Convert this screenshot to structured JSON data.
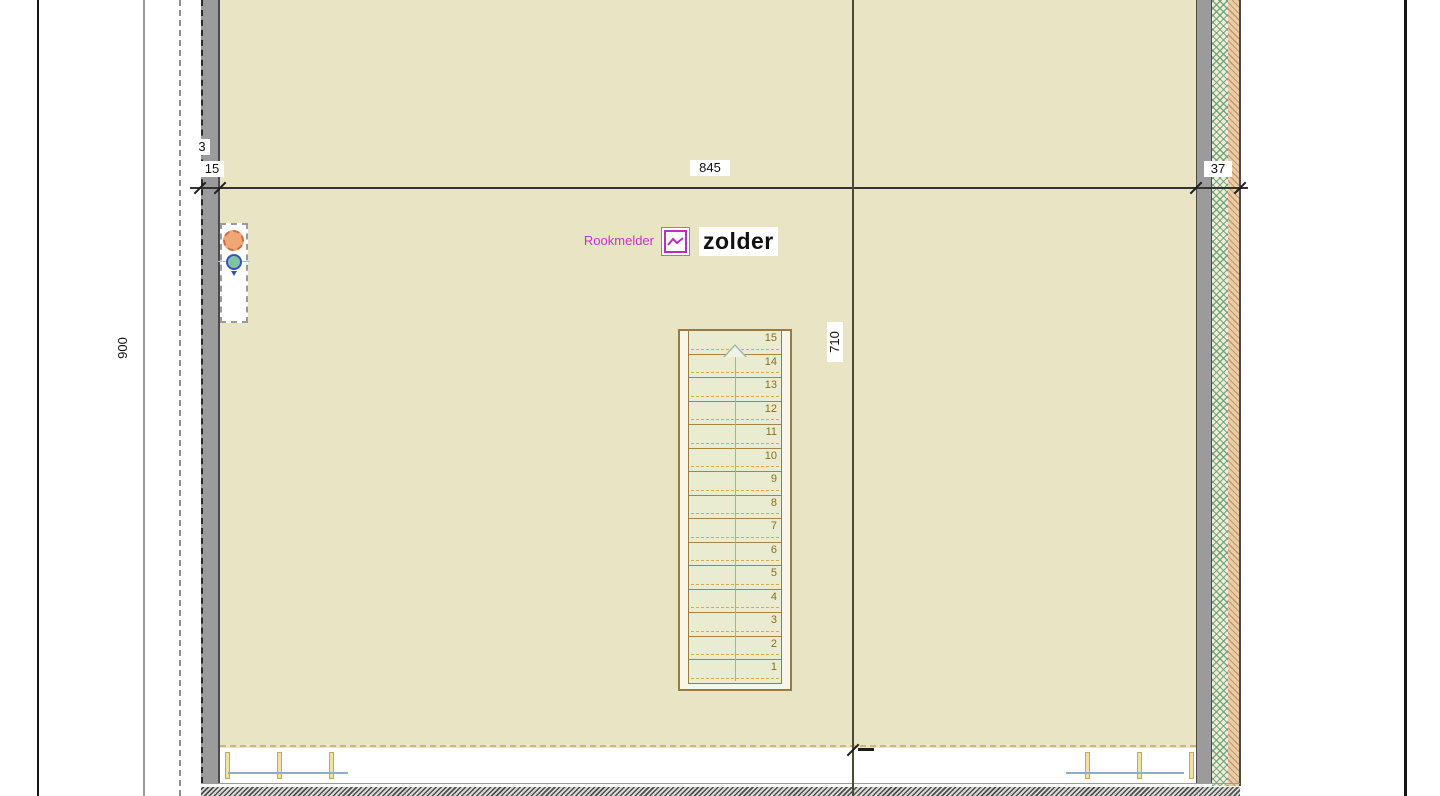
{
  "drawing": {
    "room": {
      "title": "zolder"
    },
    "annotation": {
      "label": "Rookmelder",
      "icon": "smoke-detector-icon"
    },
    "dimensions": {
      "top_offset": "3",
      "top_left_wall": "15",
      "top_span": "845",
      "top_right_wall": "37",
      "left_height": "900",
      "stair_run": "710"
    },
    "stair": {
      "steps": [
        "15",
        "14",
        "13",
        "12",
        "11",
        "10",
        "9",
        "8",
        "7",
        "6",
        "5",
        "4",
        "3",
        "2",
        "1"
      ],
      "direction": "up"
    },
    "colors": {
      "floor": "#e9e5c4",
      "wall_gray": "#9b9b9b",
      "annotation_magenta": "#c435c4",
      "window_blue": "#8cacd0",
      "stair_brown": "#a58445",
      "stair_dash_orange": "#d9a94f",
      "hatch_green": "#60a06e",
      "hatch_red": "#b45f4b"
    }
  }
}
